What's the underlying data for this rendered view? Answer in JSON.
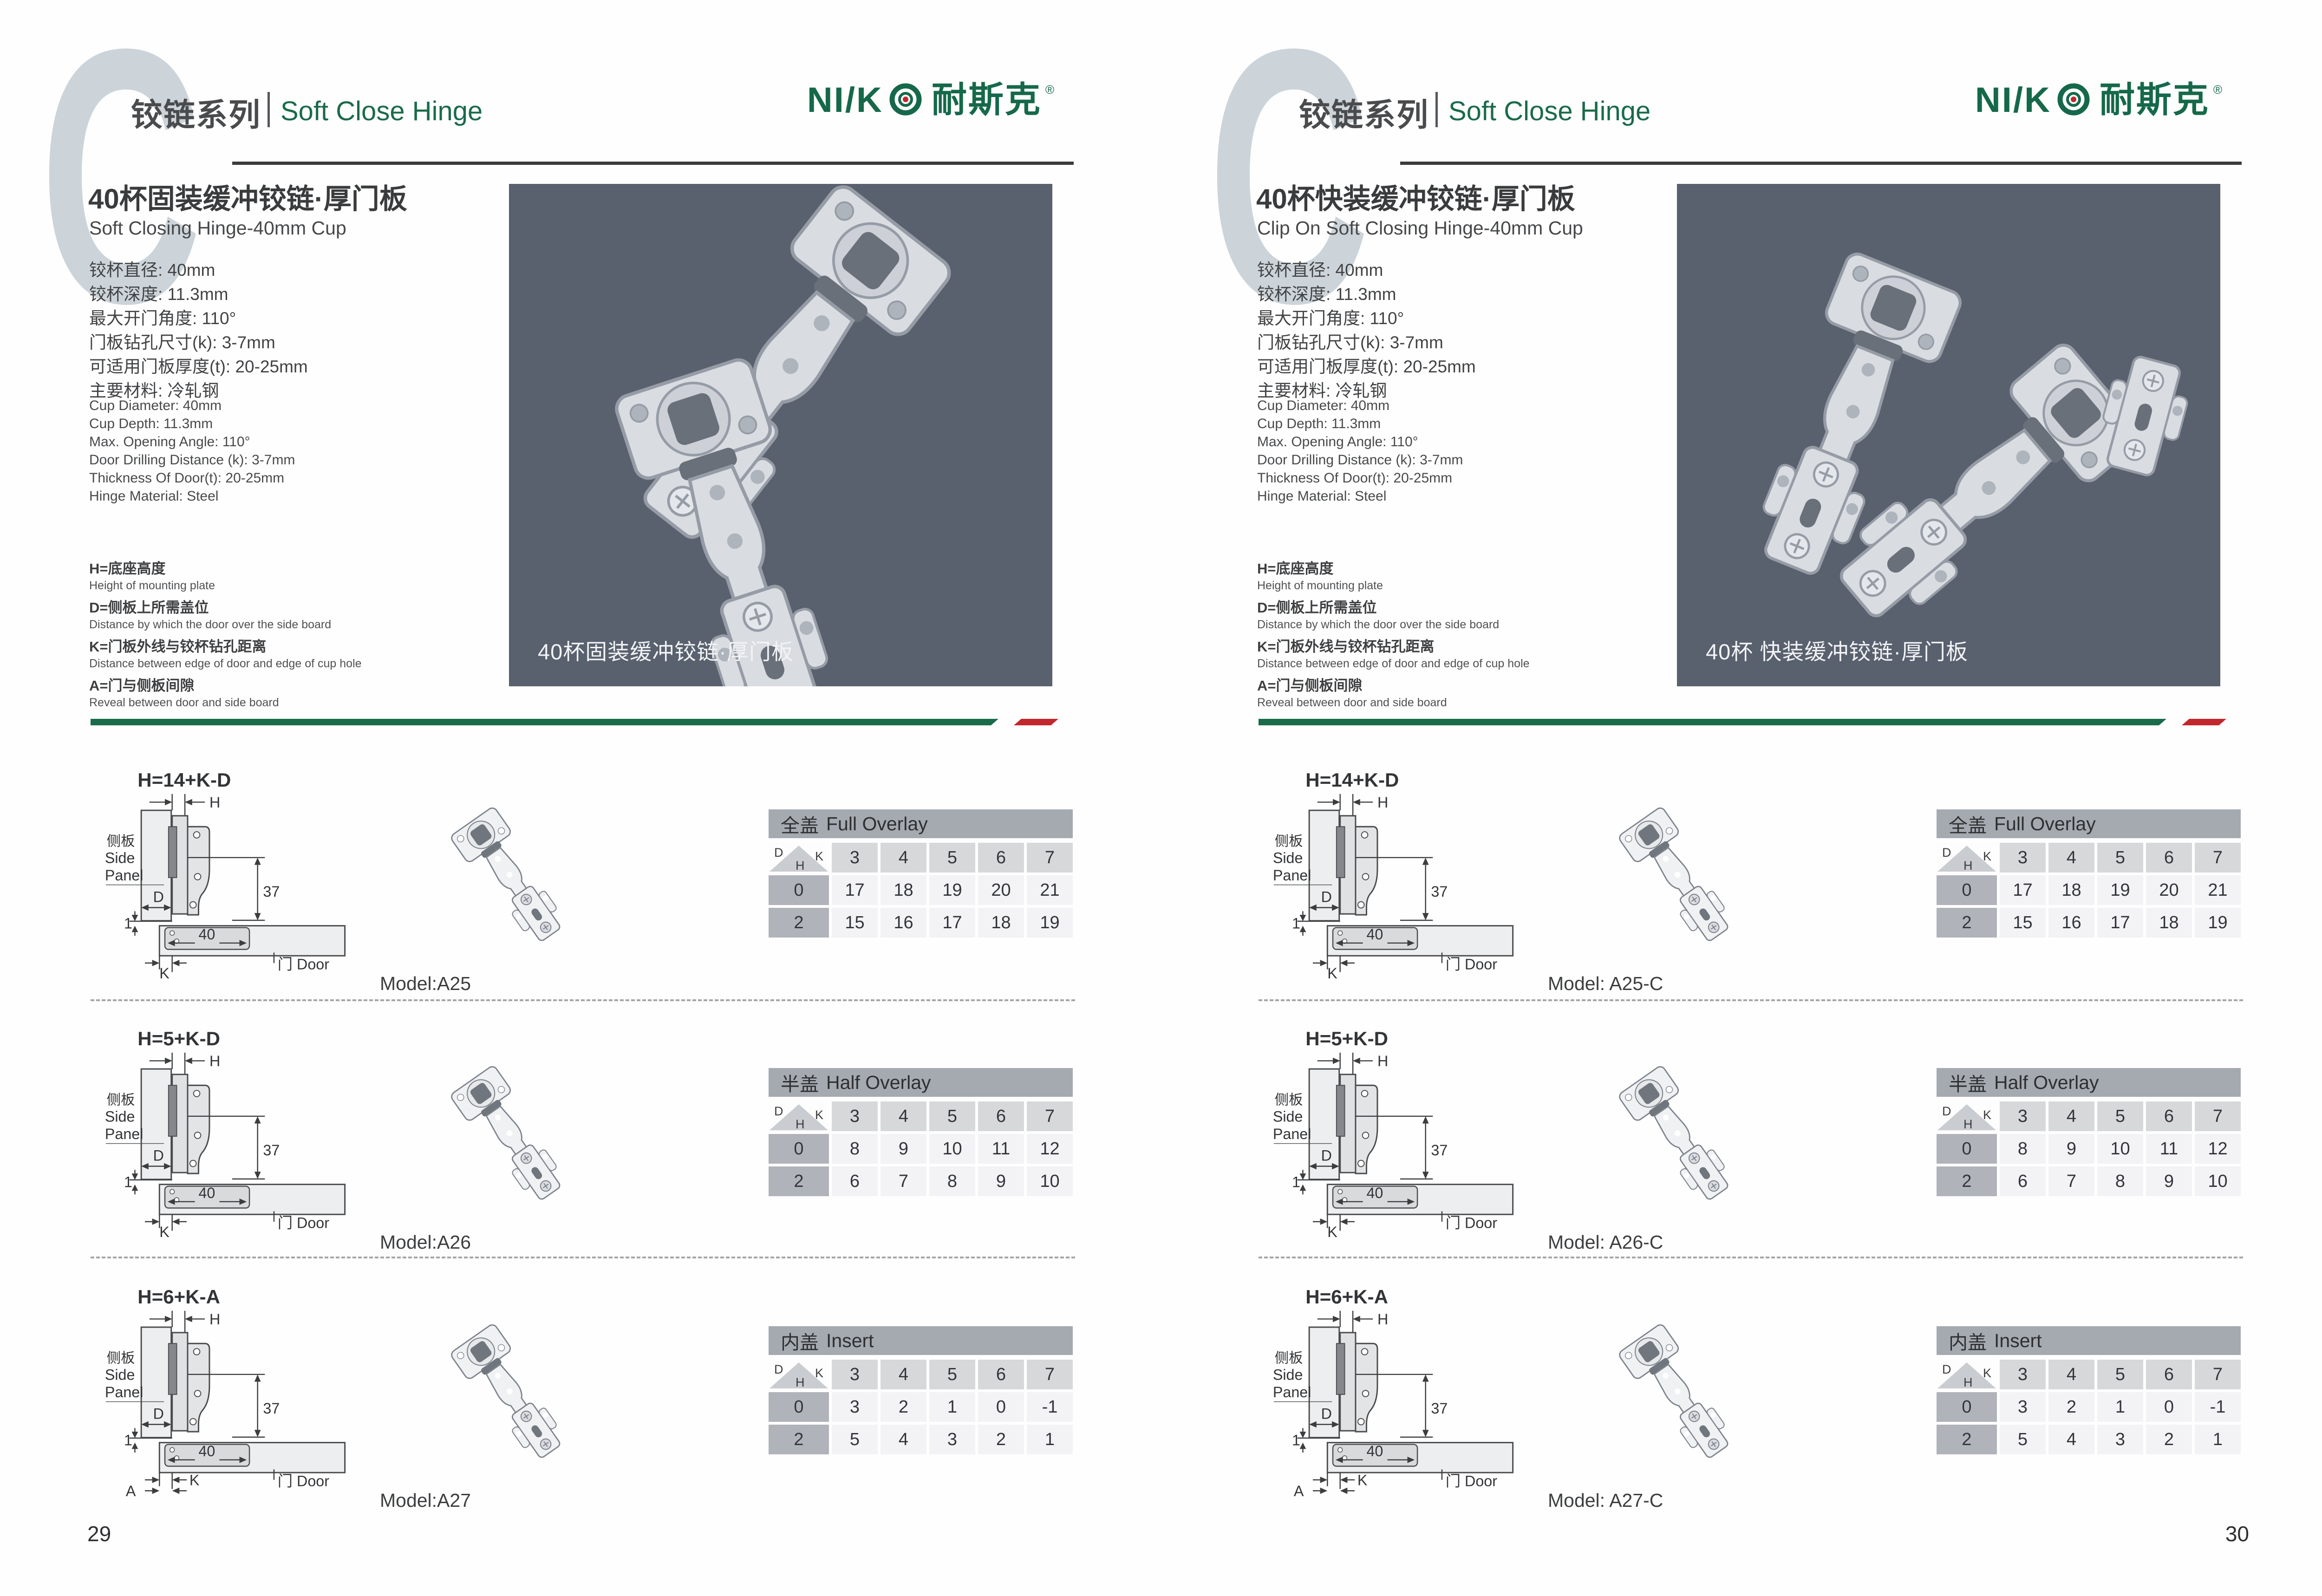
{
  "colors": {
    "accent_green": "#1a6b4a",
    "brand_green": "#15694a",
    "accent_red": "#c1272d",
    "photo_bg": "#59606e",
    "watermark_gray": "#ccd4da",
    "table_title_bg": "#a5aab1",
    "table_colhead_bg": "#d6d8da",
    "table_rowhead_bg": "#b0b3b9",
    "table_cell_bg": "#f3f3f5"
  },
  "shared": {
    "watermark_letter": "C",
    "series_zh": "铰链系列",
    "series_en": "Soft Close Hinge",
    "logo": {
      "en": "NI/K",
      "cn": "耐斯克",
      "reg": "®"
    },
    "specs_zh": [
      "铰杯直径: 40mm",
      "铰杯深度: 11.3mm",
      "最大开门角度: 110°",
      "门板钻孔尺寸(k): 3-7mm",
      "可适用门板厚度(t): 20-25mm",
      "主要材料: 冷轧钢"
    ],
    "specs_en": [
      "Cup Diameter: 40mm",
      "Cup Depth: 11.3mm",
      "Max. Opening Angle: 110°",
      "Door Drilling Distance (k): 3-7mm",
      "Thickness Of Door(t): 20-25mm",
      "Hinge Material: Steel"
    ],
    "legend": [
      {
        "zh": "H=底座高度",
        "en": "Height of mounting plate"
      },
      {
        "zh": "D=侧板上所需盖位",
        "en": "Distance by which the door over the side board"
      },
      {
        "zh": "K=门板外线与铰杯钻孔距离",
        "en": "Distance between edge of door and edge of cup hole"
      },
      {
        "zh": "A=门与侧板间隙",
        "en": "Reveal between door and side board"
      }
    ],
    "corner": {
      "d": "D",
      "k": "K",
      "h": "H"
    },
    "diagram": {
      "side_panel_zh": "侧板",
      "side_panel_en_1": "Side",
      "side_panel_en_2": "Panel",
      "door": "门 Door",
      "dim_h": "H",
      "dim_d": "D",
      "dim_37": "37",
      "dim_1": "1",
      "dim_40": "40",
      "dim_k": "K",
      "dim_a": "A"
    }
  },
  "pages": [
    {
      "page_number": "29",
      "title_zh": "40杯固装缓冲铰链·厚门板",
      "title_en": "Soft Closing Hinge-40mm Cup",
      "photo_caption": "40杯固装缓冲铰链·厚门板",
      "photo_hinge_count": 2,
      "sections": [
        {
          "formula": "H=14+K-D",
          "show_a": false,
          "model": "Model:A25",
          "table": {
            "title_zh": "全盖",
            "title_en": "Full Overlay",
            "k_values": [
              "3",
              "4",
              "5",
              "6",
              "7"
            ],
            "rows": [
              {
                "h": "0",
                "values": [
                  "17",
                  "18",
                  "19",
                  "20",
                  "21"
                ]
              },
              {
                "h": "2",
                "values": [
                  "15",
                  "16",
                  "17",
                  "18",
                  "19"
                ]
              }
            ]
          }
        },
        {
          "formula": "H=5+K-D",
          "show_a": false,
          "model": "Model:A26",
          "table": {
            "title_zh": "半盖",
            "title_en": "Half Overlay",
            "k_values": [
              "3",
              "4",
              "5",
              "6",
              "7"
            ],
            "rows": [
              {
                "h": "0",
                "values": [
                  "8",
                  "9",
                  "10",
                  "11",
                  "12"
                ]
              },
              {
                "h": "2",
                "values": [
                  "6",
                  "7",
                  "8",
                  "9",
                  "10"
                ]
              }
            ]
          }
        },
        {
          "formula": "H=6+K-A",
          "show_a": true,
          "model": "Model:A27",
          "table": {
            "title_zh": "内盖",
            "title_en": "Insert",
            "k_values": [
              "3",
              "4",
              "5",
              "6",
              "7"
            ],
            "rows": [
              {
                "h": "0",
                "values": [
                  "3",
                  "2",
                  "1",
                  "0",
                  "-1"
                ]
              },
              {
                "h": "2",
                "values": [
                  "5",
                  "4",
                  "3",
                  "2",
                  "1"
                ]
              }
            ]
          }
        }
      ]
    },
    {
      "page_number": "30",
      "title_zh": "40杯快装缓冲铰链·厚门板",
      "title_en": "Clip On Soft Closing Hinge-40mm Cup",
      "photo_caption": "40杯 快装缓冲铰链·厚门板",
      "photo_hinge_count": 3,
      "sections": [
        {
          "formula": "H=14+K-D",
          "show_a": false,
          "model": "Model: A25-C",
          "table": {
            "title_zh": "全盖",
            "title_en": "Full Overlay",
            "k_values": [
              "3",
              "4",
              "5",
              "6",
              "7"
            ],
            "rows": [
              {
                "h": "0",
                "values": [
                  "17",
                  "18",
                  "19",
                  "20",
                  "21"
                ]
              },
              {
                "h": "2",
                "values": [
                  "15",
                  "16",
                  "17",
                  "18",
                  "19"
                ]
              }
            ]
          }
        },
        {
          "formula": "H=5+K-D",
          "show_a": false,
          "model": "Model: A26-C",
          "table": {
            "title_zh": "半盖",
            "title_en": "Half Overlay",
            "k_values": [
              "3",
              "4",
              "5",
              "6",
              "7"
            ],
            "rows": [
              {
                "h": "0",
                "values": [
                  "8",
                  "9",
                  "10",
                  "11",
                  "12"
                ]
              },
              {
                "h": "2",
                "values": [
                  "6",
                  "7",
                  "8",
                  "9",
                  "10"
                ]
              }
            ]
          }
        },
        {
          "formula": "H=6+K-A",
          "show_a": true,
          "model": "Model: A27-C",
          "table": {
            "title_zh": "内盖",
            "title_en": "Insert",
            "k_values": [
              "3",
              "4",
              "5",
              "6",
              "7"
            ],
            "rows": [
              {
                "h": "0",
                "values": [
                  "3",
                  "2",
                  "1",
                  "0",
                  "-1"
                ]
              },
              {
                "h": "2",
                "values": [
                  "5",
                  "4",
                  "3",
                  "2",
                  "1"
                ]
              }
            ]
          }
        }
      ]
    }
  ]
}
